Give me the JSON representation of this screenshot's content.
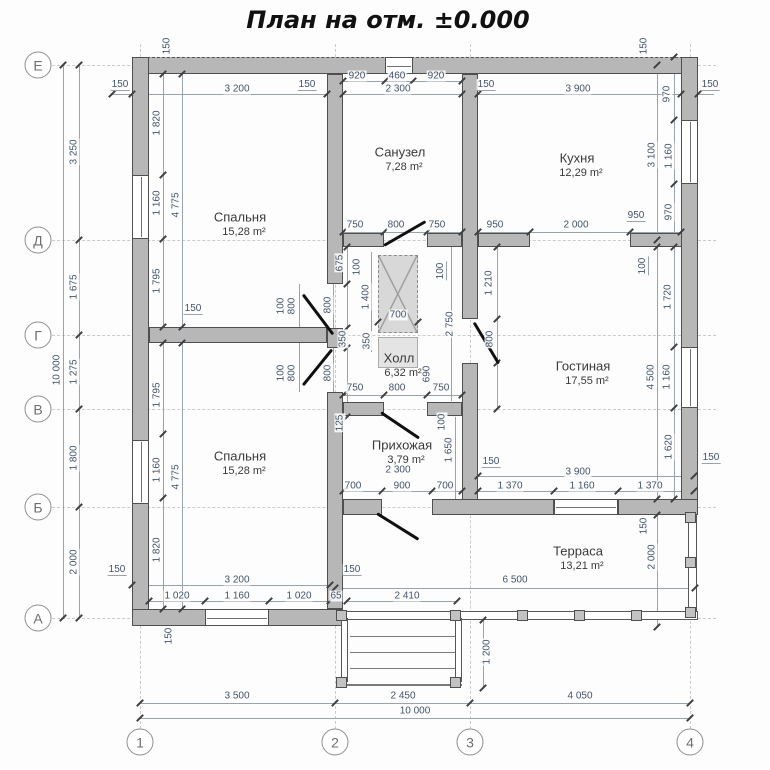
{
  "title": "План на отм. ±0.000",
  "colors": {
    "wall_fill": "#b7b7b7",
    "wall_edge": "#4f4f4f",
    "dimension_text": "#44546a",
    "room_text": "#3a3a3a",
    "axis_text": "#6e6e6e",
    "dimension_line": "#9aa3ab",
    "door_leaf": "#101010"
  },
  "axes": {
    "rows": [
      {
        "label": "Е",
        "y": 65
      },
      {
        "label": "Д",
        "y": 240
      },
      {
        "label": "Г",
        "y": 335
      },
      {
        "label": "В",
        "y": 409
      },
      {
        "label": "Б",
        "y": 507
      },
      {
        "label": "А",
        "y": 618
      }
    ],
    "cols": [
      {
        "label": "1",
        "x": 140
      },
      {
        "label": "2",
        "x": 335
      },
      {
        "label": "3",
        "x": 470
      },
      {
        "label": "4",
        "x": 690
      }
    ]
  },
  "rooms": [
    {
      "name": "Спальня",
      "area": "15,28 m²",
      "x": 240,
      "y": 217
    },
    {
      "name": "Санузел",
      "area": "7,28 m²",
      "x": 400,
      "y": 152
    },
    {
      "name": "Кухня",
      "area": "12,29 m²",
      "x": 577,
      "y": 158
    },
    {
      "name": "Холл",
      "area": "6,32 m²",
      "x": 399,
      "y": 358
    },
    {
      "name": "Гостиная",
      "area": "17,55 m²",
      "x": 583,
      "y": 366
    },
    {
      "name": "Спальня",
      "area": "15,28 m²",
      "x": 240,
      "y": 456
    },
    {
      "name": "Прихожая",
      "area": "3,79 m²",
      "x": 402,
      "y": 445
    },
    {
      "name": "Терраса",
      "area": "13,21 m²",
      "x": 578,
      "y": 551
    }
  ],
  "dims": [
    {
      "t": "150",
      "x": 120,
      "y": 85,
      "l": 1
    },
    {
      "t": "3 200",
      "x": 237,
      "y": 89
    },
    {
      "t": "150",
      "x": 307,
      "y": 85,
      "l": 1
    },
    {
      "t": "920",
      "x": 357,
      "y": 76
    },
    {
      "t": "460",
      "x": 397,
      "y": 76
    },
    {
      "t": "920",
      "x": 436,
      "y": 76
    },
    {
      "t": "2 300",
      "x": 398,
      "y": 89
    },
    {
      "t": "150",
      "x": 486,
      "y": 85,
      "l": 1
    },
    {
      "t": "3 900",
      "x": 578,
      "y": 89
    },
    {
      "t": "150",
      "x": 710,
      "y": 85,
      "l": 1
    },
    {
      "t": "150",
      "x": 167,
      "y": 46,
      "r": 1
    },
    {
      "t": "150",
      "x": 644,
      "y": 46,
      "r": 1
    },
    {
      "t": "3 250",
      "x": 74,
      "y": 152,
      "r": 1
    },
    {
      "t": "1 675",
      "x": 74,
      "y": 287,
      "r": 1
    },
    {
      "t": "1 275",
      "x": 74,
      "y": 372,
      "r": 1
    },
    {
      "t": "1 800",
      "x": 74,
      "y": 458,
      "r": 1
    },
    {
      "t": "2 000",
      "x": 74,
      "y": 562,
      "r": 1
    },
    {
      "t": "10 000",
      "x": 57,
      "y": 370,
      "r": 1
    },
    {
      "t": "1 820",
      "x": 157,
      "y": 123,
      "r": 1
    },
    {
      "t": "1 160",
      "x": 157,
      "y": 203,
      "r": 1
    },
    {
      "t": "4 775",
      "x": 176,
      "y": 205,
      "r": 1
    },
    {
      "t": "1 795",
      "x": 157,
      "y": 281,
      "r": 1
    },
    {
      "t": "150",
      "x": 193,
      "y": 309,
      "l": 1
    },
    {
      "t": "1 795",
      "x": 157,
      "y": 395,
      "r": 1
    },
    {
      "t": "1 160",
      "x": 157,
      "y": 470,
      "r": 1
    },
    {
      "t": "4 775",
      "x": 176,
      "y": 477,
      "r": 1
    },
    {
      "t": "1 820",
      "x": 157,
      "y": 550,
      "r": 1
    },
    {
      "t": "750",
      "x": 355,
      "y": 225
    },
    {
      "t": "800",
      "x": 396,
      "y": 225
    },
    {
      "t": "750",
      "x": 437,
      "y": 225
    },
    {
      "t": "950",
      "x": 495,
      "y": 225
    },
    {
      "t": "2 000",
      "x": 576,
      "y": 225
    },
    {
      "t": "950",
      "x": 636,
      "y": 216,
      "l": 1
    },
    {
      "t": "970",
      "x": 667,
      "y": 94,
      "r": 1
    },
    {
      "t": "3 100",
      "x": 652,
      "y": 155,
      "r": 1
    },
    {
      "t": "1 160",
      "x": 669,
      "y": 156,
      "r": 1
    },
    {
      "t": "970",
      "x": 669,
      "y": 212,
      "r": 1
    },
    {
      "t": "100",
      "x": 643,
      "y": 266,
      "r": 1,
      "l": 1
    },
    {
      "t": "1 720",
      "x": 668,
      "y": 297,
      "r": 1
    },
    {
      "t": "4 500",
      "x": 651,
      "y": 377,
      "r": 1
    },
    {
      "t": "1 160",
      "x": 667,
      "y": 377,
      "r": 1
    },
    {
      "t": "1 620",
      "x": 669,
      "y": 447,
      "r": 1
    },
    {
      "t": "150",
      "x": 711,
      "y": 458,
      "l": 1
    },
    {
      "t": "675",
      "x": 340,
      "y": 263,
      "r": 1
    },
    {
      "t": "800",
      "x": 328,
      "y": 305,
      "r": 1
    },
    {
      "t": "350",
      "x": 343,
      "y": 339,
      "r": 1
    },
    {
      "t": "800",
      "x": 328,
      "y": 373,
      "r": 1
    },
    {
      "t": "100",
      "x": 281,
      "y": 306,
      "r": 1
    },
    {
      "t": "800",
      "x": 292,
      "y": 306,
      "r": 1
    },
    {
      "t": "100",
      "x": 281,
      "y": 373,
      "r": 1
    },
    {
      "t": "800",
      "x": 292,
      "y": 373,
      "r": 1
    },
    {
      "t": "100",
      "x": 357,
      "y": 267,
      "r": 1
    },
    {
      "t": "1 400",
      "x": 366,
      "y": 297,
      "r": 1
    },
    {
      "t": "700",
      "x": 398,
      "y": 315
    },
    {
      "t": "350",
      "x": 367,
      "y": 341,
      "r": 1
    },
    {
      "t": "100",
      "x": 441,
      "y": 271,
      "r": 1,
      "l": 1
    },
    {
      "t": "1 210",
      "x": 489,
      "y": 283,
      "r": 1
    },
    {
      "t": "2 750",
      "x": 450,
      "y": 324,
      "r": 1
    },
    {
      "t": "800",
      "x": 490,
      "y": 339,
      "r": 1
    },
    {
      "t": "690",
      "x": 427,
      "y": 374,
      "r": 1
    },
    {
      "t": "750",
      "x": 355,
      "y": 388
    },
    {
      "t": "800",
      "x": 397,
      "y": 388
    },
    {
      "t": "750",
      "x": 441,
      "y": 388
    },
    {
      "t": "125",
      "x": 340,
      "y": 423,
      "r": 1
    },
    {
      "t": "100",
      "x": 442,
      "y": 422,
      "r": 1
    },
    {
      "t": "1 650",
      "x": 449,
      "y": 450,
      "r": 1
    },
    {
      "t": "2 300",
      "x": 398,
      "y": 470
    },
    {
      "t": "150",
      "x": 491,
      "y": 462,
      "l": 1
    },
    {
      "t": "700",
      "x": 353,
      "y": 486
    },
    {
      "t": "900",
      "x": 402,
      "y": 486
    },
    {
      "t": "700",
      "x": 445,
      "y": 486
    },
    {
      "t": "3 900",
      "x": 578,
      "y": 472
    },
    {
      "t": "1 370",
      "x": 510,
      "y": 486
    },
    {
      "t": "1 160",
      "x": 582,
      "y": 486
    },
    {
      "t": "1 370",
      "x": 650,
      "y": 486
    },
    {
      "t": "150",
      "x": 644,
      "y": 526,
      "r": 1
    },
    {
      "t": "2 000",
      "x": 652,
      "y": 557,
      "r": 1
    },
    {
      "t": "6 500",
      "x": 515,
      "y": 580
    },
    {
      "t": "150",
      "x": 352,
      "y": 570,
      "l": 1
    },
    {
      "t": "150",
      "x": 117,
      "y": 570,
      "l": 1
    },
    {
      "t": "3 200",
      "x": 237,
      "y": 580
    },
    {
      "t": "1 020",
      "x": 177,
      "y": 596
    },
    {
      "t": "1 160",
      "x": 237,
      "y": 596
    },
    {
      "t": "1 020",
      "x": 299,
      "y": 596
    },
    {
      "t": "65",
      "x": 336,
      "y": 596
    },
    {
      "t": "2 410",
      "x": 407,
      "y": 596
    },
    {
      "t": "150",
      "x": 169,
      "y": 636,
      "r": 1
    },
    {
      "t": "1 200",
      "x": 487,
      "y": 652,
      "r": 1
    },
    {
      "t": "3 500",
      "x": 237,
      "y": 696
    },
    {
      "t": "2 450",
      "x": 403,
      "y": 696
    },
    {
      "t": "4 050",
      "x": 580,
      "y": 696
    },
    {
      "t": "10 000",
      "x": 415,
      "y": 711
    }
  ],
  "geometry": {
    "walls": [
      [
        132,
        57,
        566,
        17
      ],
      [
        132,
        57,
        17,
        569
      ],
      [
        681,
        57,
        17,
        458
      ],
      [
        132,
        609,
        211,
        17
      ],
      [
        327,
        74,
        16,
        210
      ],
      [
        327,
        328,
        16,
        20
      ],
      [
        327,
        392,
        16,
        217
      ],
      [
        149,
        327,
        178,
        16
      ],
      [
        462,
        74,
        16,
        245
      ],
      [
        462,
        363,
        16,
        152
      ],
      [
        343,
        233,
        41,
        14
      ],
      [
        427,
        233,
        35,
        14
      ],
      [
        478,
        233,
        52,
        14
      ],
      [
        630,
        233,
        52,
        14
      ],
      [
        343,
        402,
        41,
        14
      ],
      [
        427,
        402,
        35,
        14
      ],
      [
        343,
        499,
        39,
        16
      ],
      [
        432,
        499,
        122,
        16
      ],
      [
        618,
        499,
        80,
        16
      ]
    ],
    "windows": [
      [
        132,
        175,
        17,
        64,
        "v"
      ],
      [
        132,
        440,
        17,
        64,
        "v"
      ],
      [
        385,
        57,
        28,
        17,
        "h"
      ],
      [
        681,
        120,
        17,
        64,
        "v"
      ],
      [
        681,
        347,
        17,
        61,
        "v"
      ],
      [
        554,
        499,
        64,
        16,
        "h"
      ],
      [
        205,
        609,
        64,
        17,
        "h"
      ]
    ],
    "doors": [
      [
        303,
        293,
        50,
        53
      ],
      [
        332,
        348,
        46,
        129
      ],
      [
        384,
        244,
        48,
        -30
      ],
      [
        474,
        321,
        48,
        59
      ],
      [
        381,
        411,
        46,
        34
      ],
      [
        377,
        512,
        49,
        32
      ]
    ],
    "dimlines": [
      [
        63,
        65,
        1,
        553
      ],
      [
        79,
        65,
        1,
        553
      ],
      [
        140,
        703,
        550,
        1
      ],
      [
        140,
        718,
        550,
        1
      ],
      [
        112,
        94,
        602,
        1
      ],
      [
        343,
        81,
        119,
        1
      ],
      [
        343,
        232,
        338,
        1
      ],
      [
        343,
        395,
        119,
        1
      ],
      [
        478,
        476,
        216,
        1
      ],
      [
        343,
        491,
        351,
        1
      ],
      [
        335,
        588,
        360,
        1
      ],
      [
        132,
        585,
        198,
        1
      ],
      [
        149,
        601,
        181,
        1
      ],
      [
        347,
        601,
        110,
        1
      ],
      [
        163,
        74,
        1,
        535
      ],
      [
        182,
        74,
        1,
        535
      ],
      [
        674,
        57,
        1,
        458
      ],
      [
        657,
        65,
        1,
        175
      ],
      [
        657,
        247,
        1,
        252
      ],
      [
        657,
        515,
        1,
        112
      ],
      [
        347,
        247,
        1,
        170
      ],
      [
        333,
        284,
        1,
        108
      ],
      [
        299,
        284,
        1,
        108
      ],
      [
        451,
        247,
        1,
        154
      ],
      [
        497,
        247,
        1,
        162
      ],
      [
        455,
        417,
        1,
        82
      ],
      [
        371,
        252,
        1,
        100
      ],
      [
        378,
        322,
        40,
        1
      ],
      [
        483,
        620,
        1,
        68
      ]
    ],
    "ticks": [
      [
        63,
        65
      ],
      [
        63,
        618
      ],
      [
        79,
        65
      ],
      [
        79,
        240
      ],
      [
        79,
        335
      ],
      [
        79,
        409
      ],
      [
        79,
        507
      ],
      [
        79,
        618
      ],
      [
        140,
        703
      ],
      [
        335,
        703
      ],
      [
        470,
        703
      ],
      [
        690,
        703
      ],
      [
        140,
        718
      ],
      [
        690,
        718
      ],
      [
        112,
        94
      ],
      [
        132,
        94
      ],
      [
        327,
        94
      ],
      [
        343,
        94
      ],
      [
        462,
        94
      ],
      [
        478,
        94
      ],
      [
        681,
        94
      ],
      [
        698,
        94
      ],
      [
        343,
        81
      ],
      [
        385,
        81
      ],
      [
        413,
        81
      ],
      [
        462,
        81
      ],
      [
        343,
        232
      ],
      [
        384,
        232
      ],
      [
        427,
        232
      ],
      [
        462,
        232
      ],
      [
        478,
        232
      ],
      [
        530,
        232
      ],
      [
        630,
        232
      ],
      [
        681,
        232
      ],
      [
        343,
        395
      ],
      [
        384,
        395
      ],
      [
        427,
        395
      ],
      [
        462,
        395
      ],
      [
        343,
        491
      ],
      [
        382,
        491
      ],
      [
        432,
        491
      ],
      [
        462,
        491
      ],
      [
        478,
        491
      ],
      [
        554,
        491
      ],
      [
        618,
        491
      ],
      [
        694,
        491
      ],
      [
        478,
        476
      ],
      [
        694,
        476
      ],
      [
        163,
        74
      ],
      [
        163,
        175
      ],
      [
        163,
        239
      ],
      [
        163,
        327
      ],
      [
        163,
        343
      ],
      [
        163,
        434
      ],
      [
        163,
        498
      ],
      [
        163,
        609
      ],
      [
        182,
        74
      ],
      [
        182,
        327
      ],
      [
        182,
        343
      ],
      [
        182,
        609
      ],
      [
        674,
        57
      ],
      [
        674,
        120
      ],
      [
        674,
        184
      ],
      [
        674,
        247
      ],
      [
        674,
        347
      ],
      [
        674,
        408
      ],
      [
        674,
        499
      ],
      [
        657,
        65
      ],
      [
        657,
        240
      ],
      [
        657,
        247
      ],
      [
        657,
        499
      ],
      [
        657,
        515
      ],
      [
        657,
        627
      ],
      [
        335,
        588
      ],
      [
        695,
        588
      ],
      [
        149,
        601
      ],
      [
        205,
        601
      ],
      [
        269,
        601
      ],
      [
        330,
        601
      ],
      [
        347,
        601
      ],
      [
        457,
        601
      ],
      [
        132,
        585
      ],
      [
        330,
        585
      ],
      [
        347,
        247
      ],
      [
        347,
        284
      ],
      [
        347,
        328
      ],
      [
        347,
        348
      ],
      [
        347,
        392
      ],
      [
        347,
        417
      ],
      [
        497,
        247
      ],
      [
        497,
        319
      ],
      [
        497,
        363
      ],
      [
        497,
        409
      ],
      [
        483,
        620
      ],
      [
        483,
        688
      ],
      [
        378,
        322
      ],
      [
        418,
        322
      ]
    ],
    "rails": [
      [
        688,
        515,
        9,
        100
      ],
      [
        343,
        611,
        355,
        9
      ],
      [
        341,
        618,
        7,
        64
      ],
      [
        455,
        618,
        7,
        64
      ]
    ],
    "treads": [
      [
        350,
        636,
        105,
        1
      ],
      [
        350,
        652,
        105,
        1
      ],
      [
        350,
        668,
        105,
        1
      ],
      [
        341,
        684,
        121,
        2
      ]
    ],
    "posts": [
      [
        336,
        610
      ],
      [
        450,
        610
      ],
      [
        517,
        610
      ],
      [
        574,
        610
      ],
      [
        631,
        610
      ],
      [
        685,
        607
      ],
      [
        685,
        512
      ],
      [
        685,
        557
      ],
      [
        336,
        677
      ],
      [
        450,
        677
      ]
    ],
    "hatch": {
      "x": 378,
      "y": 255,
      "w": 40,
      "h": 78,
      "sub": {
        "x": 378,
        "y": 337,
        "w": 40,
        "h": 31
      }
    }
  }
}
